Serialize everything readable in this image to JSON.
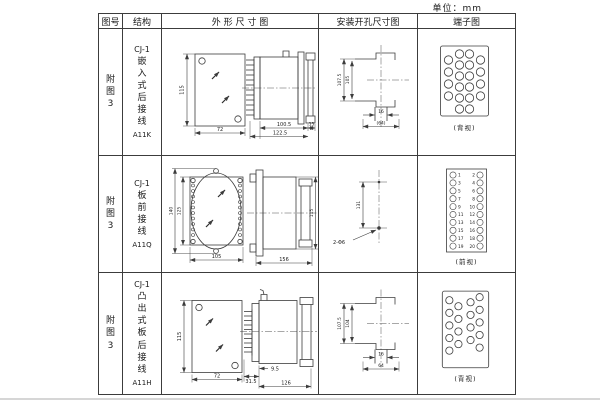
{
  "unit": "单位：mm",
  "headers": {
    "fig": "图号",
    "structure": "结构",
    "outline": "外 形 尺 寸 图",
    "mounting": "安装开孔尺寸图",
    "terminal": "端子图"
  },
  "rows": [
    {
      "fig": "附图3",
      "model": "CJ-1",
      "structure": "嵌入式后接线",
      "code": "A11K",
      "dims": {
        "height": "115",
        "width": "72",
        "body": "100.5",
        "depth": "122.5",
        "panel": "15"
      },
      "mount": {
        "outer": "107.5",
        "inner": "105",
        "slot": "16",
        "width": "(64)"
      },
      "terminal": {
        "view": "(背视)"
      }
    },
    {
      "fig": "附图3",
      "model": "CJ-1",
      "structure": "板前接线",
      "code": "A11Q",
      "dims": {
        "outer_h": "140",
        "inner_h": "125",
        "width": "105",
        "depth": "156",
        "side_h": "115"
      },
      "mount": {
        "pitch": "131",
        "holes": "2-Φ6"
      },
      "terminal": {
        "view": "(前视)",
        "left": [
          "1",
          "3",
          "5",
          "7",
          "9",
          "11",
          "13",
          "15",
          "17",
          "19"
        ],
        "right": [
          "2",
          "4",
          "6",
          "8",
          "10",
          "12",
          "14",
          "16",
          "18",
          "20"
        ]
      }
    },
    {
      "fig": "附图3",
      "model": "CJ-1",
      "structure": "凸出式板后接线",
      "code": "A11H",
      "dims": {
        "height": "115",
        "width": "72",
        "pins": "31.5",
        "offset": "9.5",
        "depth": "126"
      },
      "mount": {
        "outer": "107.5",
        "inner": "104",
        "slot": "16",
        "width": "64"
      },
      "terminal": {
        "view": "(背视)"
      }
    }
  ]
}
